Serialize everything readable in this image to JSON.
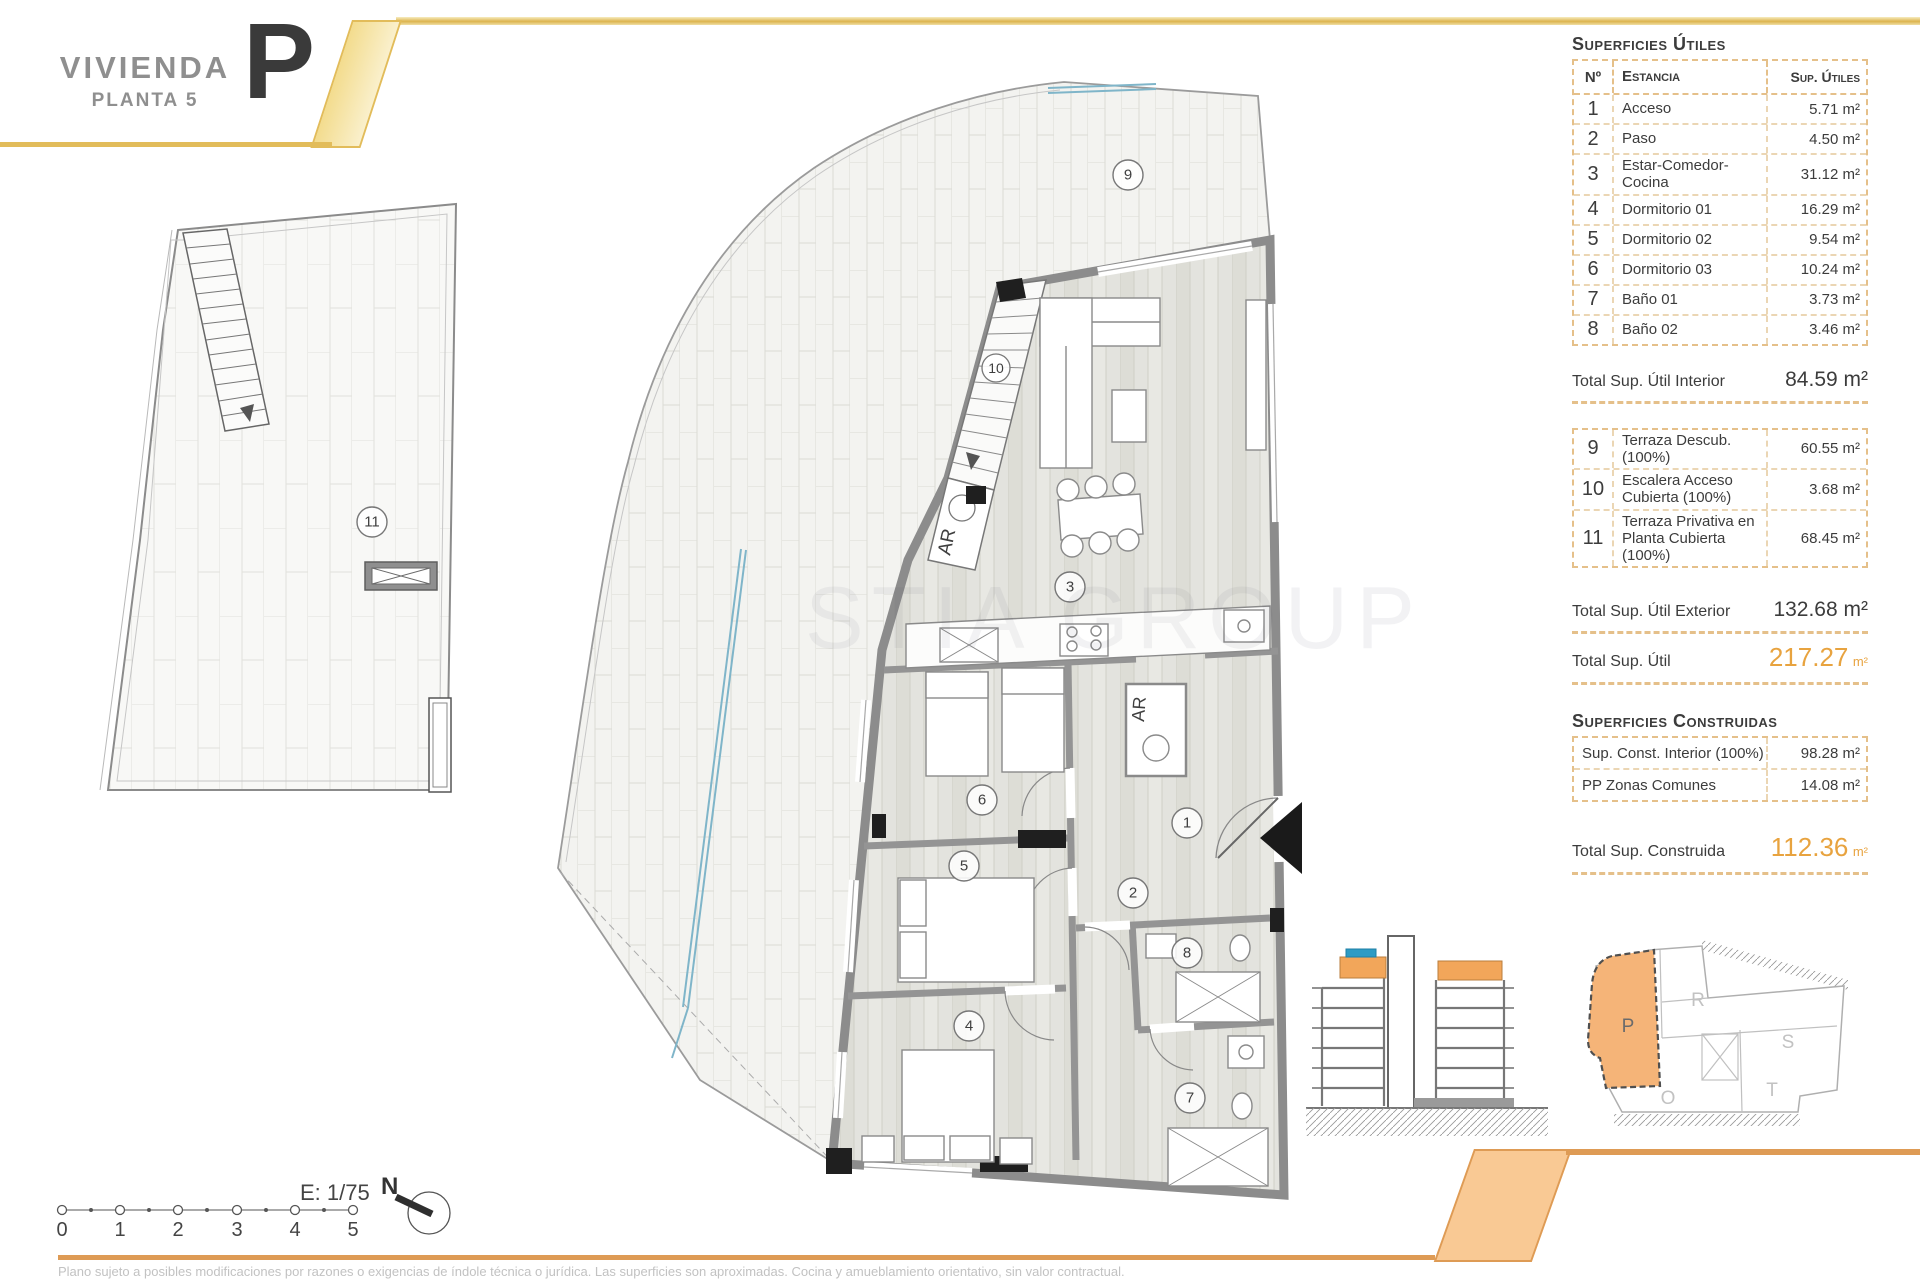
{
  "title": {
    "vivienda": "VIVIENDA",
    "planta": "PLANTA 5",
    "letter": "P"
  },
  "superficies_utiles": {
    "heading": "Superficies Útiles",
    "columns": {
      "no": "Nº",
      "estancia": "Estancia",
      "sup": "Sup. Útiles"
    },
    "rows": [
      {
        "no": "1",
        "estancia": "Acceso",
        "sup": "5.71 m²"
      },
      {
        "no": "2",
        "estancia": "Paso",
        "sup": "4.50 m²"
      },
      {
        "no": "3",
        "estancia": "Estar-Comedor-Cocina",
        "sup": "31.12 m²"
      },
      {
        "no": "4",
        "estancia": "Dormitorio 01",
        "sup": "16.29 m²"
      },
      {
        "no": "5",
        "estancia": "Dormitorio 02",
        "sup": "9.54 m²"
      },
      {
        "no": "6",
        "estancia": "Dormitorio 03",
        "sup": "10.24 m²"
      },
      {
        "no": "7",
        "estancia": "Baño 01",
        "sup": "3.73 m²"
      },
      {
        "no": "8",
        "estancia": "Baño 02",
        "sup": "3.46 m²"
      }
    ],
    "total_interior": {
      "label": "Total Sup. Útil Interior",
      "value": "84.59 m²"
    },
    "exterior_rows": [
      {
        "no": "9",
        "estancia": "Terraza Descub.(100%)",
        "sup": "60.55 m²"
      },
      {
        "no": "10",
        "estancia": "Escalera Acceso Cubierta (100%)",
        "sup": "3.68 m²"
      },
      {
        "no": "11",
        "estancia": "Terraza Privativa en Planta Cubierta (100%)",
        "sup": "68.45 m²"
      }
    ],
    "total_exterior": {
      "label": "Total Sup. Útil Exterior",
      "value": "132.68 m²"
    },
    "total": {
      "label": "Total Sup. Útil",
      "value": "217.27",
      "unit": "m²"
    }
  },
  "superficies_construidas": {
    "heading": "Superficies Construidas",
    "rows": [
      {
        "label": "Sup. Const. Interior (100%)",
        "value": "98.28 m²"
      },
      {
        "label": "PP Zonas Comunes",
        "value": "14.08 m²"
      }
    ],
    "total": {
      "label": "Total Sup. Construida",
      "value": "112.36",
      "unit": "m²"
    }
  },
  "plan_labels": {
    "n1": "1",
    "n2": "2",
    "n3": "3",
    "n4": "4",
    "n5": "5",
    "n6": "6",
    "n7": "7",
    "n8": "8",
    "n9": "9",
    "n10": "10",
    "n11": "11",
    "ar": "AR"
  },
  "scale_bar": {
    "label": "E: 1/75",
    "ticks": [
      "0",
      "1",
      "2",
      "3",
      "4",
      "5"
    ]
  },
  "north": {
    "label": "N"
  },
  "key_plan": {
    "p": "P",
    "r": "R",
    "s": "S",
    "o": "O",
    "t": "T"
  },
  "watermark": "STIA GROUP",
  "disclaimer": "Plano sujeto a posibles modificaciones por razones o exigencias de índole técnica o jurídica. Las superficies son aproximadas. Cocina y amueblamiento orientativo, sin valor contractual.",
  "colors": {
    "accent_gold": "#E2BC5A",
    "accent_orange": "#DE9B55",
    "band_fill": "#F9C994",
    "unit_highlight": "#F5B478",
    "totals_orange": "#E8A33F",
    "glass_blue": "#7FB5C9",
    "pool_blue": "#2E9BC4"
  }
}
